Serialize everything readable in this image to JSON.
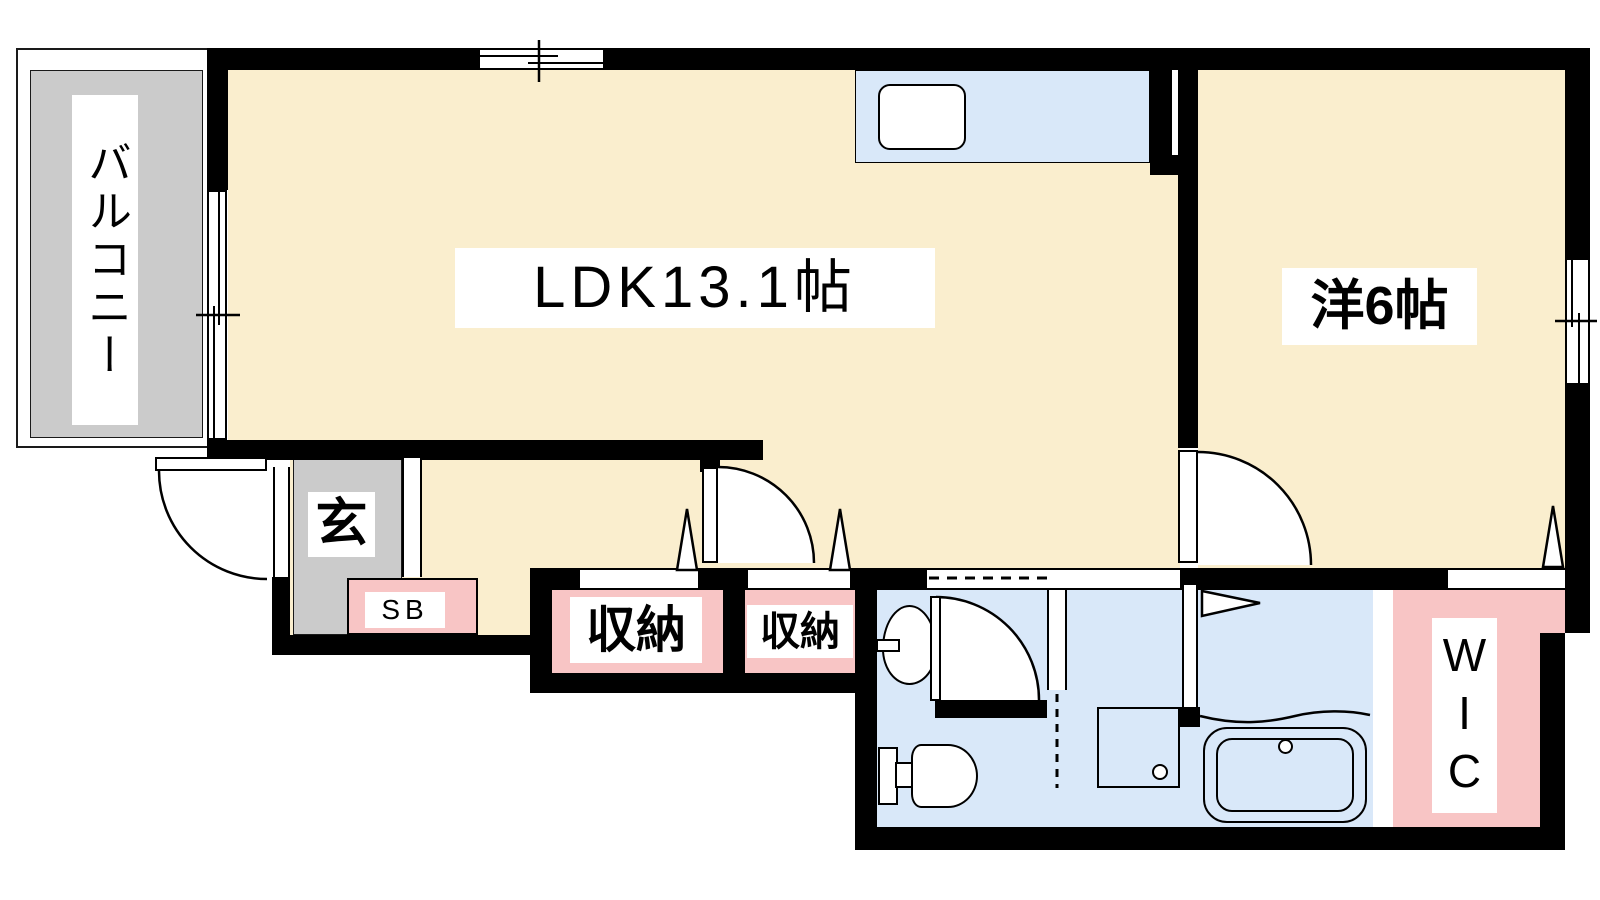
{
  "floorplan": {
    "balcony_label": "バルコニー",
    "ldk_label": "LDK13.1帖",
    "western_room_label": "洋6帖",
    "entrance_label": "玄",
    "shoebox_label": "SB",
    "storage1_label": "収納",
    "storage2_label": "収納",
    "wic_label": "WIC",
    "colors": {
      "room_cream": "#FAEECE",
      "balcony_gray": "#CBCBCB",
      "closet_pink": "#F8C5C5",
      "water_blue": "#D9E8F9",
      "wall_black": "#000000",
      "label_background": "#FFFFFF"
    }
  }
}
